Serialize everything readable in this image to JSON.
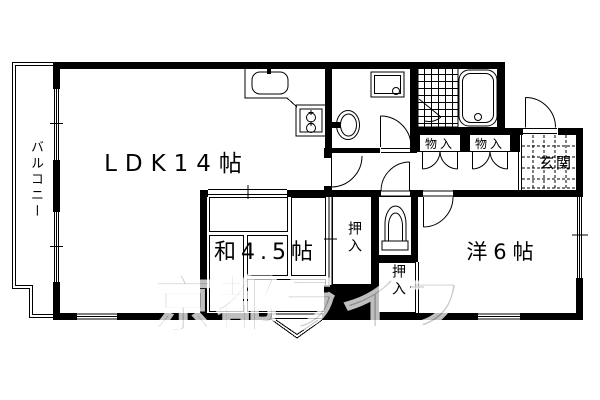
{
  "floorplan": {
    "labels": {
      "balcony": "バルコニー",
      "ldk": "LDK14帖",
      "japanese_room": "和4.5帖",
      "western_room": "洋6帖",
      "entrance": "玄関",
      "closet_japanese": "押入",
      "closet_western": "押入",
      "storage_1": "物入",
      "storage_2": "物入"
    },
    "watermark": "京都ライフ",
    "colors": {
      "wall": "#000000",
      "background": "#ffffff",
      "watermark": "#b9b9b9"
    },
    "fixtures": [
      "kitchen-sink",
      "gas-stove",
      "washbasin",
      "washing-machine",
      "bathtub",
      "toilet",
      "bathroom-tile",
      "entrance-tile",
      "tatami"
    ]
  }
}
